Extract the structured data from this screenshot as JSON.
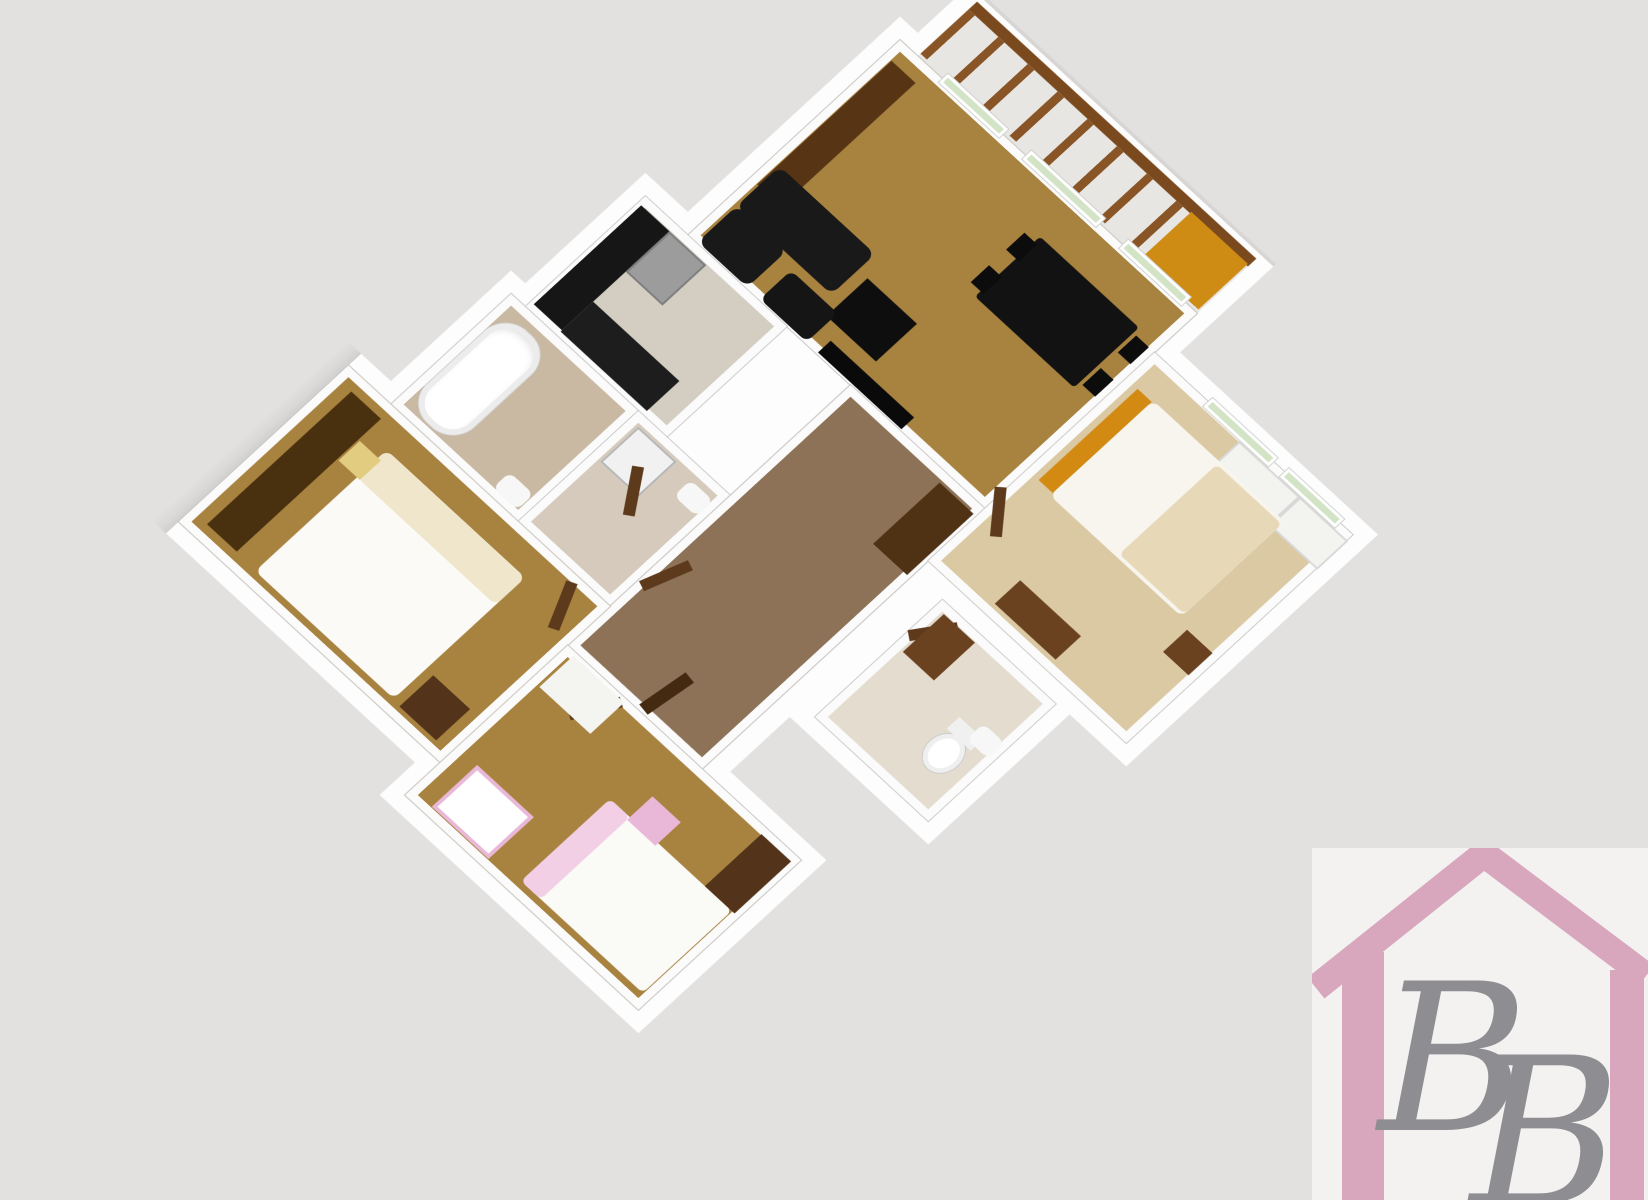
{
  "page": {
    "background": "#e2e1e0"
  },
  "plan": {
    "position": {
      "left": 760,
      "top": -50
    },
    "size": {
      "w": 920,
      "h": 1045
    },
    "origin": "140px 90px",
    "transform": "rotateX(23deg) rotateZ(45deg)",
    "wall_color": "#fdfdfd",
    "slab_clip": "polygon(147px -4px,578px -4px,578px 132px,858px 132px,858px 488px,778px 488px,778px 688px,582px 688px,582px 772px,718px 772px,718px 1038px,352px 1038px,352px 988px,-18px 988px,-18px 712px,42px 712px,42px 542px,62px 542px,62px 372px,122px 372px,122px 72px,147px 72px)",
    "rooms": [
      {
        "name": "balcony",
        "x": 165,
        "y": 14,
        "w": 395,
        "h": 76,
        "floor": "#e7e6e3",
        "pattern": "plain",
        "noborder": true
      },
      {
        "name": "living-room",
        "x": 140,
        "y": 90,
        "w": 420,
        "h": 300,
        "floor": "#a8823f",
        "pattern": "wood"
      },
      {
        "name": "kitchen",
        "x": 80,
        "y": 390,
        "w": 200,
        "h": 170,
        "floor": "#d3cdc2",
        "pattern": "tile"
      },
      {
        "name": "bathroom",
        "x": 60,
        "y": 560,
        "w": 180,
        "h": 170,
        "floor": "#c9b8a2",
        "pattern": "plain"
      },
      {
        "name": "laundry-wc",
        "x": 240,
        "y": 560,
        "w": 130,
        "h": 170,
        "floor": "#d5cabb",
        "pattern": "plain"
      },
      {
        "name": "hallway",
        "x": 370,
        "y": 390,
        "w": 190,
        "h": 400,
        "floor": "#8d7257",
        "pattern": "carpet"
      },
      {
        "name": "bedroom-left",
        "x": 0,
        "y": 730,
        "w": 370,
        "h": 240,
        "floor": "#a8823f",
        "pattern": "wood"
      },
      {
        "name": "kids-room",
        "x": 370,
        "y": 790,
        "w": 330,
        "h": 230,
        "floor": "#a8823f",
        "pattern": "wood"
      },
      {
        "name": "bedroom-right",
        "x": 560,
        "y": 150,
        "w": 280,
        "h": 320,
        "floor": "#dbc9a4",
        "pattern": "beige"
      },
      {
        "name": "wc",
        "x": 600,
        "y": 490,
        "w": 160,
        "h": 180,
        "floor": "#e3dccf",
        "pattern": "plain"
      }
    ],
    "furniture": [
      {
        "name": "balcony-rail-top",
        "x": 165,
        "y": 6,
        "w": 395,
        "h": 12,
        "color": "#7a4a1e"
      },
      {
        "name": "balcony-balusters",
        "x": 165,
        "y": 18,
        "w": 395,
        "h": 68,
        "cls": "balusters"
      },
      {
        "name": "balcony-orange-pad",
        "x": 478,
        "y": 16,
        "w": 80,
        "h": 70,
        "color": "#cf8c14"
      },
      {
        "name": "sideboard",
        "x": 150,
        "y": 112,
        "w": 34,
        "h": 190,
        "color": "#563414"
      },
      {
        "name": "dining-table",
        "x": 390,
        "y": 142,
        "w": 140,
        "h": 92,
        "color": "#121212",
        "r": 4
      },
      {
        "name": "dining-chair",
        "x": 376,
        "y": 150,
        "w": 18,
        "h": 26,
        "color": "#0c0c0c"
      },
      {
        "name": "dining-chair",
        "x": 376,
        "y": 200,
        "w": 18,
        "h": 26,
        "color": "#0c0c0c"
      },
      {
        "name": "dining-chair",
        "x": 534,
        "y": 150,
        "w": 18,
        "h": 26,
        "color": "#0c0c0c"
      },
      {
        "name": "dining-chair",
        "x": 534,
        "y": 200,
        "w": 18,
        "h": 26,
        "color": "#0c0c0c"
      },
      {
        "name": "sofa",
        "x": 152,
        "y": 272,
        "w": 135,
        "h": 62,
        "color": "#191919",
        "r": 10
      },
      {
        "name": "sofa",
        "x": 152,
        "y": 332,
        "w": 70,
        "h": 56,
        "color": "#191919",
        "r": 10
      },
      {
        "name": "coffee-table",
        "x": 300,
        "y": 296,
        "w": 70,
        "h": 58,
        "color": "#0e0e0e"
      },
      {
        "name": "armchair",
        "x": 240,
        "y": 344,
        "w": 66,
        "h": 44,
        "color": "#151515",
        "r": 8
      },
      {
        "name": "tv-stand",
        "x": 322,
        "y": 370,
        "w": 118,
        "h": 18,
        "color": "#0a0a0a"
      },
      {
        "name": "window",
        "x": 200,
        "y": 82,
        "w": 85,
        "h": 13,
        "cls": "window"
      },
      {
        "name": "window",
        "x": 318,
        "y": 82,
        "w": 104,
        "h": 13,
        "cls": "window"
      },
      {
        "name": "window",
        "x": 455,
        "y": 82,
        "w": 88,
        "h": 13,
        "cls": "window"
      },
      {
        "name": "kitchen-counter",
        "x": 84,
        "y": 400,
        "w": 40,
        "h": 152,
        "color": "#161616"
      },
      {
        "name": "fridge",
        "x": 124,
        "y": 400,
        "w": 48,
        "h": 58,
        "color": "#9c9c9c",
        "border": "2px solid #7e7e7e"
      },
      {
        "name": "kitchen-counter",
        "x": 124,
        "y": 508,
        "w": 122,
        "h": 46,
        "color": "#1d1d1d"
      },
      {
        "name": "bathtub",
        "x": 70,
        "y": 578,
        "w": 66,
        "h": 140,
        "cls": "tub"
      },
      {
        "name": "bath-sink",
        "x": 196,
        "y": 698,
        "w": 34,
        "h": 24,
        "color": "#f7f7f7",
        "r": 8
      },
      {
        "name": "washing-machine",
        "x": 252,
        "y": 572,
        "w": 50,
        "h": 50,
        "color": "#f1f1f1",
        "border": "2px solid #b5b5b5"
      },
      {
        "name": "small-sink",
        "x": 330,
        "y": 576,
        "w": 32,
        "h": 24,
        "color": "#f7f7f7",
        "r": 8
      },
      {
        "name": "hall-cabinet",
        "x": 508,
        "y": 402,
        "w": 48,
        "h": 94,
        "color": "#4f3113"
      },
      {
        "name": "entry-door",
        "x": 470,
        "y": 728,
        "w": 14,
        "h": 58,
        "color": "#432a10",
        "rot": 8
      },
      {
        "name": "door-leaf",
        "x": 292,
        "y": 598,
        "w": 12,
        "h": 54,
        "color": "#5e3a1c",
        "rot": -35
      },
      {
        "name": "door-leaf",
        "x": 380,
        "y": 640,
        "w": 12,
        "h": 54,
        "color": "#5e3a1c",
        "rot": 20
      },
      {
        "name": "door-leaf",
        "x": 330,
        "y": 736,
        "w": 12,
        "h": 54,
        "color": "#5e3a1c",
        "rot": -25
      },
      {
        "name": "door-leaf",
        "x": 432,
        "y": 792,
        "w": 12,
        "h": 54,
        "color": "#5e3a1c",
        "rot": 30
      },
      {
        "name": "door-leaf",
        "x": 566,
        "y": 356,
        "w": 12,
        "h": 54,
        "color": "#5e3a1c",
        "rot": -40
      },
      {
        "name": "door-leaf",
        "x": 612,
        "y": 496,
        "w": 12,
        "h": 50,
        "color": "#5e3a1c",
        "rot": 35
      },
      {
        "name": "wardrobe",
        "x": 22,
        "y": 748,
        "w": 42,
        "h": 204,
        "color": "#49300f"
      },
      {
        "name": "double-bed",
        "x": 92,
        "y": 768,
        "w": 196,
        "h": 186,
        "color": "#fbfaf6",
        "r": 8
      },
      {
        "name": "bed-pillows",
        "x": 92,
        "y": 768,
        "w": 196,
        "h": 42,
        "color": "#efe6cc",
        "r": 8
      },
      {
        "name": "night-table",
        "x": 66,
        "y": 780,
        "w": 30,
        "h": 30,
        "color": "#e2cc80"
      },
      {
        "name": "dresser",
        "x": 298,
        "y": 908,
        "w": 52,
        "h": 48,
        "color": "#53341a"
      },
      {
        "name": "kids-bed",
        "x": 518,
        "y": 878,
        "w": 172,
        "h": 126,
        "color": "#fafaf7",
        "r": 6
      },
      {
        "name": "kids-bed-pink",
        "x": 518,
        "y": 878,
        "w": 28,
        "h": 126,
        "color": "#f2cfe4",
        "r": 6
      },
      {
        "name": "pink-dresser",
        "x": 546,
        "y": 846,
        "w": 40,
        "h": 36,
        "color": "#e9b7d8"
      },
      {
        "name": "crib",
        "x": 398,
        "y": 946,
        "w": 72,
        "h": 56,
        "color": "#ffffff",
        "border": "4px solid #e9b7d8"
      },
      {
        "name": "kids-desk",
        "x": 382,
        "y": 794,
        "w": 72,
        "h": 48,
        "color": "#f4f4f1"
      },
      {
        "name": "kids-wardrobe",
        "x": 652,
        "y": 798,
        "w": 42,
        "h": 80,
        "color": "#53341a"
      },
      {
        "name": "closet",
        "x": 688,
        "y": 158,
        "w": 82,
        "h": 40,
        "color": "#f3f3f0",
        "border": "2px solid #d8d8d8"
      },
      {
        "name": "closet",
        "x": 774,
        "y": 158,
        "w": 64,
        "h": 40,
        "color": "#f3f3f0",
        "border": "2px solid #d8d8d8"
      },
      {
        "name": "headboard-orange",
        "x": 576,
        "y": 190,
        "w": 20,
        "h": 140,
        "color": "#d28a12"
      },
      {
        "name": "double-bed",
        "x": 596,
        "y": 188,
        "w": 186,
        "h": 146,
        "color": "#f7f5ee",
        "r": 8
      },
      {
        "name": "bed-blanket",
        "x": 690,
        "y": 192,
        "w": 92,
        "h": 138,
        "color": "#e7d9b8",
        "r": 6
      },
      {
        "name": "night-table",
        "x": 796,
        "y": 340,
        "w": 36,
        "h": 34,
        "color": "#6b4220"
      },
      {
        "name": "dresser",
        "x": 640,
        "y": 420,
        "w": 86,
        "h": 36,
        "color": "#6b4220"
      },
      {
        "name": "window",
        "x": 636,
        "y": 144,
        "w": 92,
        "h": 13,
        "cls": "window"
      },
      {
        "name": "window",
        "x": 744,
        "y": 144,
        "w": 78,
        "h": 13,
        "cls": "window"
      },
      {
        "name": "toilet",
        "x": 700,
        "y": 584,
        "w": 38,
        "h": 46,
        "cls": "toilet"
      },
      {
        "name": "toilet-tank",
        "x": 702,
        "y": 568,
        "w": 34,
        "h": 18,
        "color": "#f0f0f0"
      },
      {
        "name": "wc-sink",
        "x": 724,
        "y": 556,
        "w": 30,
        "h": 24,
        "color": "#f7f7f7",
        "r": 8
      },
      {
        "name": "wc-cabinet",
        "x": 612,
        "y": 500,
        "w": 44,
        "h": 58,
        "color": "#6b4220"
      }
    ]
  },
  "logo": {
    "x": 1312,
    "y": 848,
    "w": 336,
    "h": 352,
    "bg": "#f3f2f1",
    "pink": "#d9a7bd",
    "gray": "#8e8e92",
    "letters": [
      "B",
      "B"
    ]
  }
}
